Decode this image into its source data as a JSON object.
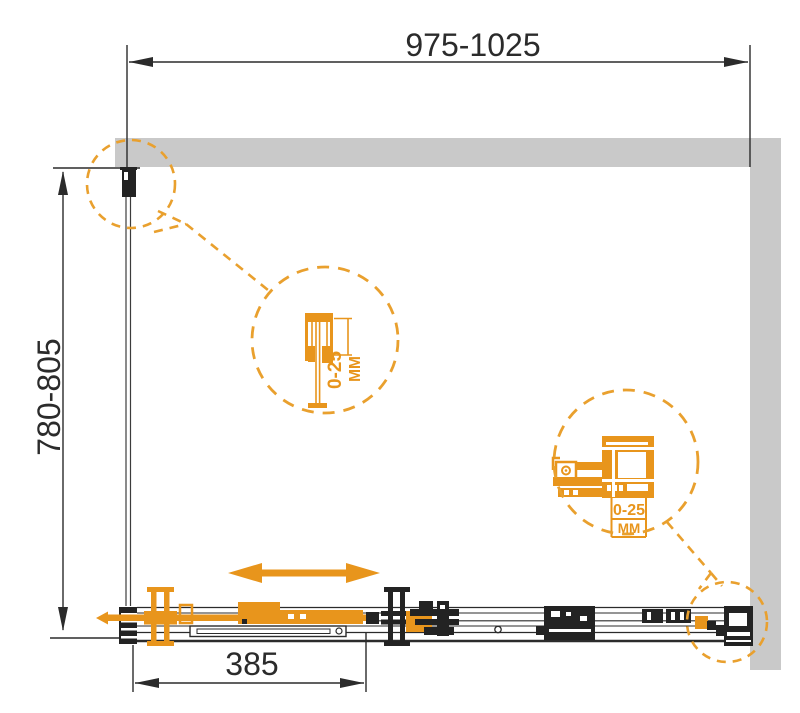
{
  "drawing": {
    "dimensions": {
      "width": {
        "label": "975-1025"
      },
      "depth": {
        "label": "780-805"
      },
      "door": {
        "label": "385"
      }
    },
    "details": {
      "wall_profile": {
        "range": "0-25",
        "unit": "ММ"
      },
      "roller": {
        "range": "0-25",
        "unit": "ММ"
      }
    },
    "colors": {
      "accent_orange": "#E8951C",
      "dashed_orange": "#E9A02E",
      "wall_gray": "#C9C9C9",
      "line_dark": "#2B2B2B"
    }
  }
}
